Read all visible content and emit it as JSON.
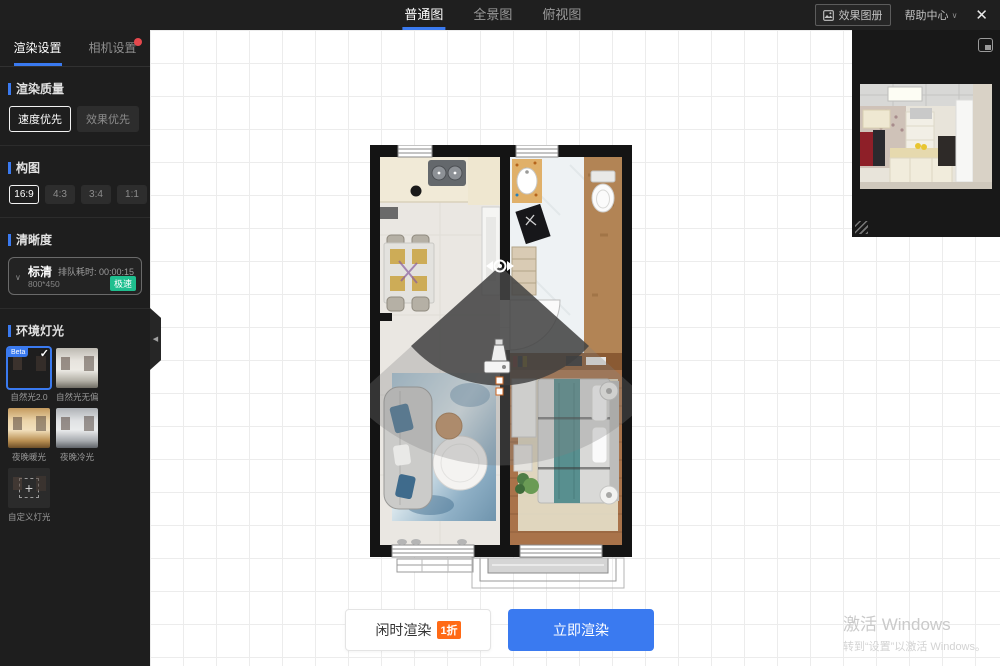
{
  "topbar": {
    "tabs": [
      {
        "label": "普通图",
        "active": true
      },
      {
        "label": "全景图",
        "active": false
      },
      {
        "label": "俯视图",
        "active": false
      }
    ],
    "album_button": "效果图册",
    "help_menu": "帮助中心",
    "help_caret": "∨",
    "close": "✕"
  },
  "sidebar": {
    "tabs": [
      {
        "label": "渲染设置",
        "active": true
      },
      {
        "label": "相机设置",
        "has_red_dot": true
      }
    ],
    "quality": {
      "title": "渲染质量",
      "options": [
        {
          "label": "速度优先",
          "selected": true
        },
        {
          "label": "效果优先",
          "selected": false
        }
      ]
    },
    "composition": {
      "title": "构图",
      "options": [
        {
          "label": "16:9",
          "selected": true
        },
        {
          "label": "4:3",
          "selected": false
        },
        {
          "label": "3:4",
          "selected": false
        },
        {
          "label": "1:1",
          "selected": false
        }
      ]
    },
    "clarity": {
      "title": "清晰度",
      "selected_name": "标清",
      "resolution": "800*450",
      "queue_label": "排队耗时: 00:00:15",
      "badge": "极速",
      "caret": "∨"
    },
    "lighting": {
      "title": "环境灯光",
      "options": [
        {
          "label": "自然光2.0",
          "beta": "Beta",
          "selected": true,
          "check": "✓"
        },
        {
          "label": "自然光无偏色",
          "selected": false
        },
        {
          "label": "夜晚暖光",
          "selected": false
        },
        {
          "label": "夜晚冷光",
          "selected": false
        },
        {
          "label": "自定义灯光",
          "custom": true,
          "plus": "+"
        }
      ]
    },
    "collapse_arrow": "◀"
  },
  "footer": {
    "idle_render": "闲时渲染",
    "idle_badge": "1折",
    "render_now": "立即渲染"
  },
  "watermark": {
    "line1": "激活 Windows",
    "line2": "转到“设置”以激活 Windows。"
  },
  "colors": {
    "accent_blue": "#3a7af0",
    "badge_orange": "#ff6a16",
    "badge_green": "#1fbf8f",
    "alert_red": "#e5484d",
    "topbar_bg": "#1f1f1f",
    "sidebar_bg": "#1e1e1e"
  }
}
